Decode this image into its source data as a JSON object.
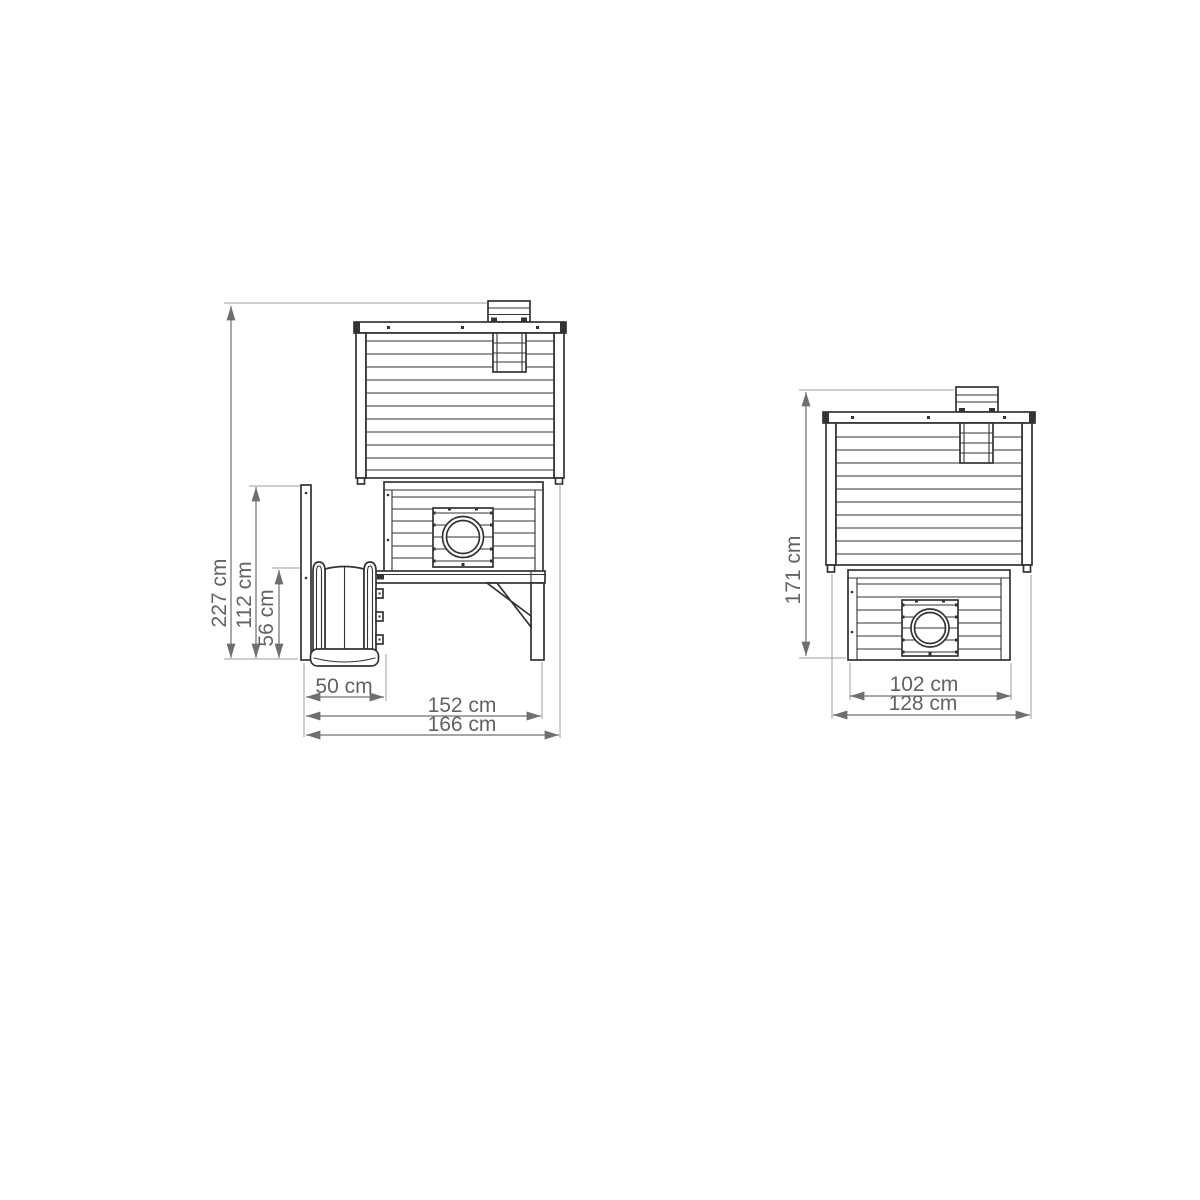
{
  "canvas": {
    "width": 1200,
    "height": 1200,
    "background_color": "#ffffff"
  },
  "style": {
    "drawing_line_color": "#333333",
    "dimension_line_color": "#6f6f6f",
    "extension_line_color": "#9e9e9e",
    "dimension_text_color": "#636363"
  },
  "figure": {
    "description": "Technical dimension drawing of a wooden playhouse/coop with slide — side view (left) and front view (right)",
    "views": {
      "side": {
        "name": "side-view-with-slide",
        "dims": {
          "overall_height": "227 cm",
          "post_height": "112 cm",
          "slide_height": "56 cm",
          "slide_depth": "50 cm",
          "base_depth": "152 cm",
          "overall_depth": "166 cm"
        }
      },
      "front": {
        "name": "front-view",
        "dims": {
          "overall_height": "171 cm",
          "body_width": "102 cm",
          "roof_width": "128 cm"
        }
      }
    }
  }
}
